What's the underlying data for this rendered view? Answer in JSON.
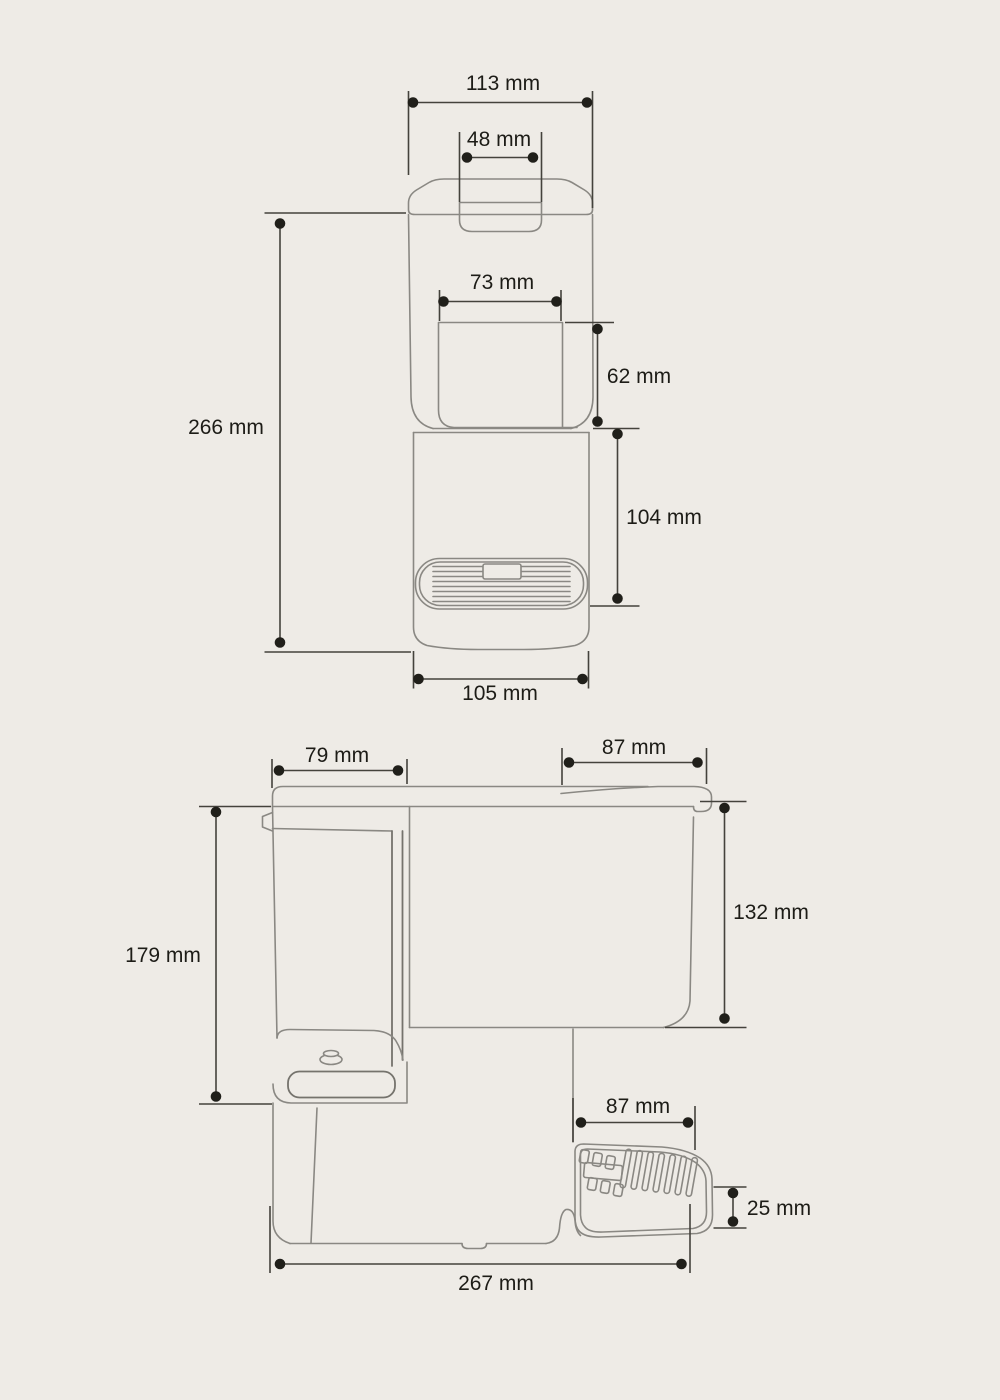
{
  "unit": "mm",
  "colors": {
    "background": "#eeebe6",
    "drawing_line": "#8a8883",
    "dimension_line": "#44423c",
    "text": "#1d1c17"
  },
  "front_view": {
    "dims": {
      "top_width": "113 mm",
      "lid_handle_width": "48 mm",
      "window_width": "73 mm",
      "window_height": "62 mm",
      "total_height": "266 mm",
      "lower_section_height": "104 mm",
      "base_width": "105 mm"
    }
  },
  "side_view": {
    "dims": {
      "head_depth": "79 mm",
      "top_lid_depth": "87 mm",
      "body_height": "179 mm",
      "tank_height": "132 mm",
      "drip_tray_depth": "87 mm",
      "drip_tray_height": "25 mm",
      "total_depth": "267 mm"
    }
  }
}
